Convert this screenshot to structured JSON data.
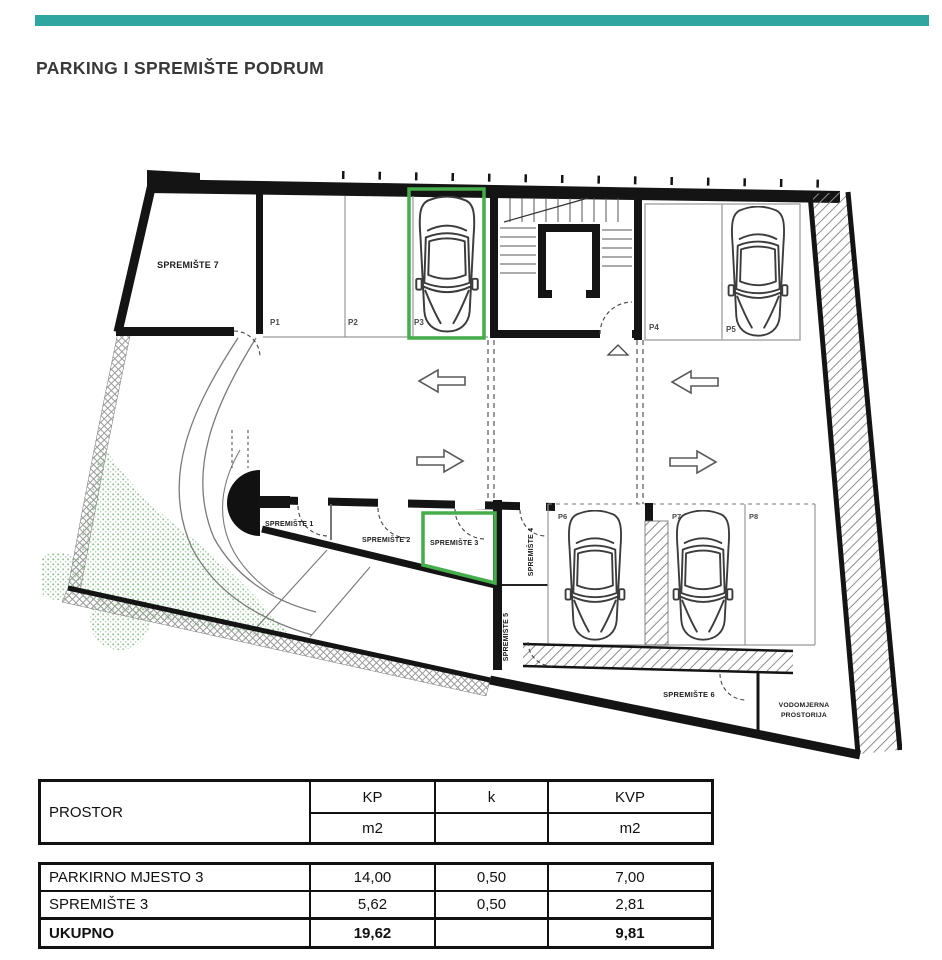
{
  "header": {
    "title": "PARKING I SPREMIŠTE PODRUM"
  },
  "colors": {
    "accent_teal": "#2fa7a0",
    "highlight_green": "#45ad4a",
    "tree_green": "#9cc79c",
    "line_black": "#141414"
  },
  "plan": {
    "rooms": {
      "s7": "SPREMIŠTE 7",
      "s1": "SPREMIŠTE 1",
      "s2": "SPREMIŠTE 2",
      "s3": "SPREMIŠTE 3",
      "s4": "SPREMIŠTE 4",
      "s5": "SPREMIŠTE 5",
      "s6": "SPREMIŠTE 6",
      "vod1": "VODOMJERNA",
      "vod2": "PROSTORIJA"
    },
    "parking": {
      "p1": "P1",
      "p2": "P2",
      "p3": "P3",
      "p4": "P4",
      "p5": "P5",
      "p6": "P6",
      "p7": "P7",
      "p8": "P8"
    }
  },
  "table": {
    "headers": {
      "prostor": "PROSTOR",
      "kp": "KP",
      "k": "k",
      "kvp": "KVP",
      "kp_unit": "m2",
      "k_unit": "",
      "kvp_unit": "m2"
    },
    "rows": [
      {
        "label": "PARKIRNO MJESTO 3",
        "kp": "14,00",
        "k": "0,50",
        "kvp": "7,00"
      },
      {
        "label": "SPREMIŠTE 3",
        "kp": "5,62",
        "k": "0,50",
        "kvp": "2,81"
      }
    ],
    "total": {
      "label": "UKUPNO",
      "kp": "19,62",
      "k": "",
      "kvp": "9,81"
    }
  }
}
